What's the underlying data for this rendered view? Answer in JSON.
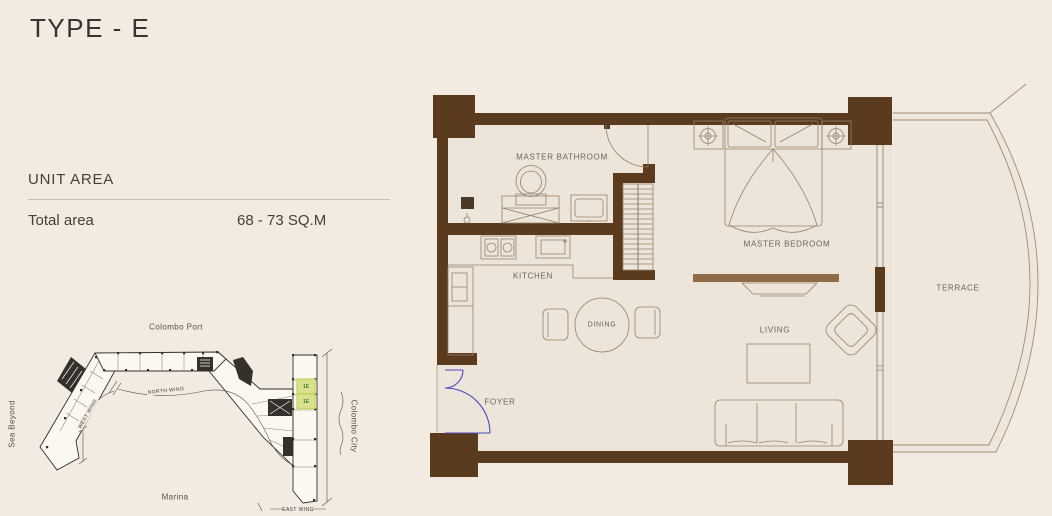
{
  "page": {
    "title": "TYPE - E"
  },
  "unit_area": {
    "heading": "UNIT AREA",
    "total_label": "Total area",
    "total_value": "68 - 73 SQ.M"
  },
  "site_map": {
    "labels": {
      "top": "Colombo Port",
      "left": "Sea Beyond",
      "bottom": "Marina",
      "right": "Colombo City",
      "north_wing": "NORTH WING",
      "west_wing": "WEST WING",
      "east_wing": "EAST WING"
    },
    "highlighted_units": {
      "unit_1": "1E",
      "unit_2": "1E"
    },
    "colors": {
      "outline": "#33302C",
      "highlight_fill": "#D9E18C",
      "highlight_border": "#C9D35B",
      "highlight_text": "#3F7D42"
    }
  },
  "floor_plan": {
    "rooms": {
      "master_bathroom": "MASTER BATHROOM",
      "master_bedroom": "MASTER BEDROOM",
      "kitchen": "KITCHEN",
      "dining": "DINING",
      "living": "LIVING",
      "foyer": "FOYER",
      "terrace": "TERRACE"
    },
    "colors": {
      "wall": "#5B3B1E",
      "furniture_line": "#94826B",
      "terrace_line": "#9E8D77",
      "entry_door": "#4C4CBE",
      "console": "#8F6B47",
      "floor": "#EDE5DA"
    }
  }
}
